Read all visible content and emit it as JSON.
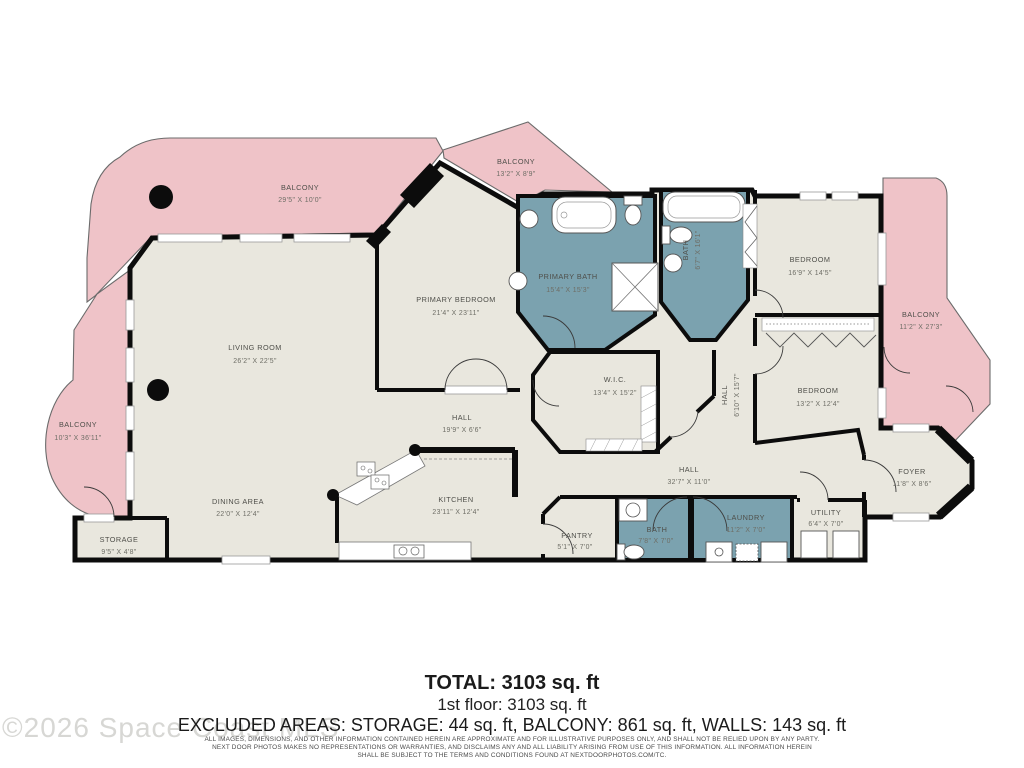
{
  "colors": {
    "balcony_pink": "#efc3c8",
    "bath_teal": "#7ba2af",
    "floor_beige": "#e9e7de",
    "wall_black": "#0c0c0c",
    "background": "#ffffff"
  },
  "rooms": [
    {
      "name": "BALCONY",
      "dims": "29'5\" X 10'0\""
    },
    {
      "name": "BALCONY",
      "dims": "13'2\" X 8'9\""
    },
    {
      "name": "BALCONY",
      "dims": "11'2\" X 27'3\""
    },
    {
      "name": "BALCONY",
      "dims": "10'3\" X 36'11\""
    },
    {
      "name": "LIVING ROOM",
      "dims": "26'2\" X 22'5\""
    },
    {
      "name": "PRIMARY BEDROOM",
      "dims": "21'4\" X 23'11\""
    },
    {
      "name": "PRIMARY BATH",
      "dims": "15'4\" X 15'3\""
    },
    {
      "name": "BATH",
      "dims": "6'7\" X 16'1\""
    },
    {
      "name": "BEDROOM",
      "dims": "16'9\" X 14'5\""
    },
    {
      "name": "BEDROOM",
      "dims": "13'2\" X 12'4\""
    },
    {
      "name": "W.I.C.",
      "dims": "13'4\" X 15'2\""
    },
    {
      "name": "HALL",
      "dims": "6'10\" X 15'7\""
    },
    {
      "name": "HALL",
      "dims": "19'9\" X 6'6\""
    },
    {
      "name": "HALL",
      "dims": "32'7\" X 11'0\""
    },
    {
      "name": "DINING AREA",
      "dims": "22'0\" X 12'4\""
    },
    {
      "name": "KITCHEN",
      "dims": "23'11\" X 12'4\""
    },
    {
      "name": "STORAGE",
      "dims": "9'5\" X 4'8\""
    },
    {
      "name": "PANTRY",
      "dims": "5'1\" X 7'0\""
    },
    {
      "name": "BATH",
      "dims": "7'8\" X 7'0\""
    },
    {
      "name": "LAUNDRY",
      "dims": "11'2\" X 7'0\""
    },
    {
      "name": "UTILITY",
      "dims": "6'4\" X 7'0\""
    },
    {
      "name": "FOYER",
      "dims": "11'8\" X 8'6\""
    }
  ],
  "footer": {
    "total": "TOTAL: 3103 sq. ft",
    "floor": "1st floor: 3103 sq. ft",
    "excluded": "EXCLUDED AREAS: STORAGE: 44 sq. ft, BALCONY: 861 sq. ft, WALLS: 143 sq. ft",
    "disclaimer1": "ALL IMAGES, DIMENSIONS, AND OTHER INFORMATION CONTAINED HEREIN ARE APPROXIMATE AND FOR ILLUSTRATIVE PURPOSES ONLY, AND SHALL NOT BE RELIED UPON BY ANY PARTY.",
    "disclaimer2": "NEXT DOOR PHOTOS MAKES NO REPRESENTATIONS OR WARRANTIES, AND DISCLAIMS ANY AND ALL LIABILITY ARISING FROM USE OF THIS INFORMATION. ALL INFORMATION HEREIN",
    "disclaimer3": "SHALL BE SUBJECT TO THE TERMS AND CONDITIONS FOUND AT NEXTDOORPHOTOS.COM/TC."
  },
  "watermark": "©2026 Space Coast MLS"
}
